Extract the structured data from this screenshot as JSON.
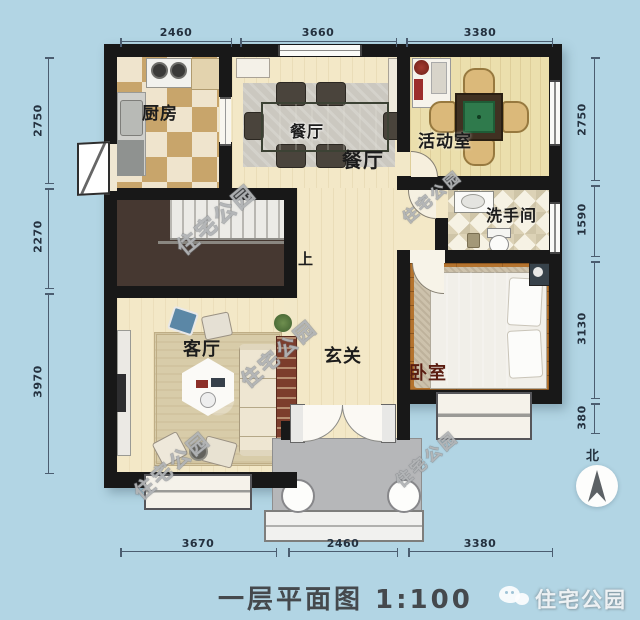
{
  "title": "一层平面图 1:100",
  "compass_label": "北",
  "watermark_text": "住宅公园",
  "brand_name": "住宅公园",
  "rooms": {
    "kitchen": "厨房",
    "dining_table_tag": "餐厅",
    "dining": "餐厅",
    "activity_room": "活动室",
    "bathroom": "洗手间",
    "bedroom": "卧室",
    "living_room": "客厅",
    "foyer": "玄关",
    "stairs_up": "上"
  },
  "dimensions_mm": {
    "top": [
      "2460",
      "3660",
      "3380"
    ],
    "bottom": [
      "3670",
      "2460",
      "3380"
    ],
    "left": [
      "2750",
      "2270",
      "3970"
    ],
    "right": [
      "2750",
      "1590",
      "3130",
      "380"
    ]
  },
  "drawing": {
    "type": "floor-plan",
    "scale": "1:100"
  },
  "colors": {
    "background": "#b2d5e4",
    "wall": "#181818",
    "floor_cream": "#f3e8c7",
    "dimension_text": "#24313f",
    "bedroom_label": "#5a1c10"
  }
}
